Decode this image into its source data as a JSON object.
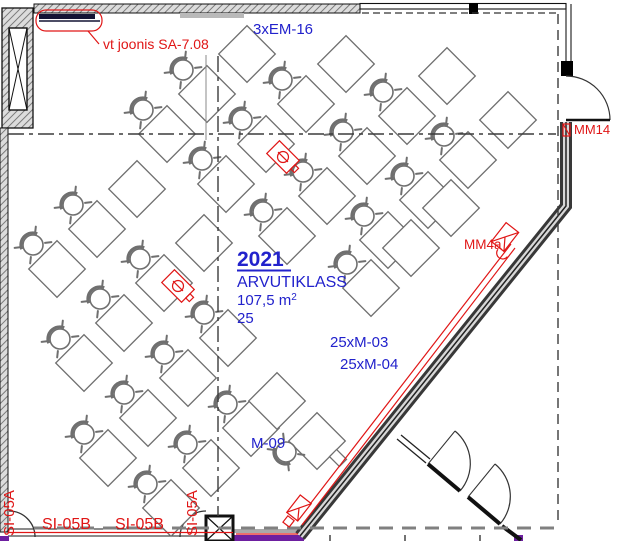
{
  "drawing": {
    "type": "floor-plan",
    "labels": {
      "em16": "3xEM-16",
      "room_number": "2021",
      "room_name": "ARVUTIKLASS",
      "area": "107,5 m",
      "area_sup": "2",
      "seats": "25",
      "m03": "25xM-03",
      "m04": "25xM-04",
      "m09": "M-09",
      "mm14": "MM14",
      "mm4a": "MM4a",
      "sa708": "vt joonis SA-7.08",
      "si05a": "SI-05A",
      "si05b": "SI-05B"
    },
    "colors": {
      "blue": "#2222cc",
      "red": "#e01616",
      "purple": "#6d1fa0",
      "gray": "#6f6f6f"
    },
    "furniture": {
      "rows": [
        {
          "x": 143,
          "y": 110,
          "chairs": 2,
          "extra_desks": 1
        },
        {
          "x": 202,
          "y": 160,
          "chairs": 3,
          "extra_desks": 1
        },
        {
          "x": 263,
          "y": 212,
          "chairs": 4,
          "extra_desks": 1
        },
        {
          "x": 364,
          "y": 216,
          "chairs": 3,
          "extra_desks": 1
        },
        {
          "x": 347,
          "y": 264,
          "chairs": 1,
          "extra_desks": 2
        },
        {
          "x": 33,
          "y": 245,
          "chairs": 2,
          "extra_desks": 1
        },
        {
          "x": 60,
          "y": 339,
          "chairs": 3,
          "extra_desks": 1
        },
        {
          "x": 84,
          "y": 434,
          "chairs": 4,
          "extra_desks": 0
        },
        {
          "x": 147,
          "y": 484,
          "chairs": 3,
          "extra_desks": 0
        }
      ],
      "teacher": {
        "desks": [
          [
            277,
            401
          ],
          [
            317,
            441
          ]
        ],
        "chair": [
          286,
          452
        ],
        "chair_rot": 225,
        "pc": [
          338,
          458
        ]
      },
      "floor_boxes": [
        [
          283,
          157
        ],
        [
          178,
          286
        ]
      ]
    }
  }
}
